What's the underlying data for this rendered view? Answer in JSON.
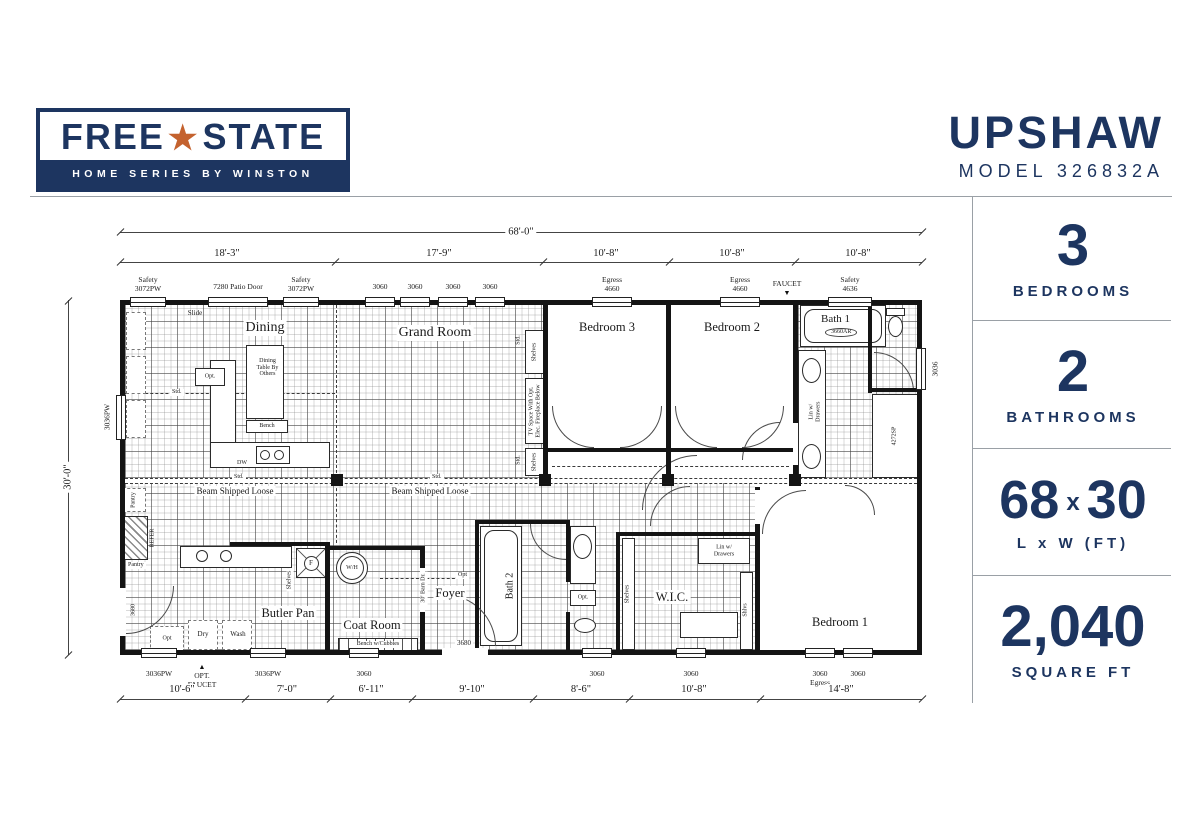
{
  "header": {
    "brand": {
      "name_left": "FREE",
      "star": "★",
      "name_right": "STATE",
      "tagline": "HOME SERIES BY WINSTON"
    },
    "model_name": "UPSHAW",
    "model_number": "MODEL 326832A"
  },
  "sidebar": {
    "spec1": {
      "value": "3",
      "label": "BEDROOMS"
    },
    "spec2": {
      "value": "2",
      "label": "BATHROOMS"
    },
    "spec3": {
      "value_a": "68",
      "sep": "x",
      "value_b": "30",
      "label": "L x W (FT)"
    },
    "spec4": {
      "value": "2,040",
      "label": "SQUARE FT"
    }
  },
  "plan": {
    "dims": {
      "overall": "68'-0\"",
      "t1": "18'-3\"",
      "t2": "17'-9\"",
      "t3": "10'-8\"",
      "t4": "10'-8\"",
      "t5": "10'-8\"",
      "b1": "10'-6\"",
      "b2": "7'-0\"",
      "b3": "6'-11\"",
      "b4": "9'-10\"",
      "b5": "8'-6\"",
      "b6": "10'-8\"",
      "b7": "14'-8\"",
      "side": "30'-0\""
    },
    "windows": {
      "safety_3072pw": "Safety\n3072PW",
      "patio_door": "7280 Patio Door",
      "w3060": "3060",
      "egress_4660": "Egress\n4660",
      "safety_4636": "Safety\n4636",
      "w3036pw": "3036PW",
      "w3036": "3036",
      "w3060_egress": "3060\nEgress",
      "d3680": "3680",
      "faucet": "FAUCET",
      "opt_faucet": "OPT.\nFAUCET"
    },
    "rooms": {
      "dining": "Dining",
      "grand": "Grand Room",
      "bed3": "Bedroom 3",
      "bed2": "Bedroom 2",
      "bath1": "Bath 1",
      "butler": "Butler Pan",
      "coat": "Coat Room",
      "foyer": "Foyer",
      "bath2": "Bath 2",
      "wic": "W.I.C.",
      "bed1": "Bedroom 1"
    },
    "notes": {
      "slide": "Slide",
      "dining_table": "Dining\nTable By\nOthers",
      "bench": "Bench",
      "opt": "Opt.",
      "opt_plain": "Opt",
      "dw": "DW",
      "std": "Std.",
      "beam": "Beam Shipped Loose",
      "shelves": "Shelves",
      "shlvs": "Shlvs",
      "tv_space": "TV Space With Opt.\nElec. Fireplace Below",
      "tub1": "3660AR",
      "shower1": "4272SP",
      "lin_drawers": "Lin w/\nDrawers",
      "pantry": "Pantry",
      "refer": "REFER",
      "dry": "Dry",
      "wash": "Wash",
      "wh": "W/H",
      "furnace": "F",
      "bench_cubbies": "Bench w/Cubbies",
      "barn_door": "30' Barn Dr."
    },
    "icons": {
      "tri_down": "▼",
      "tri_up": "▲"
    }
  }
}
